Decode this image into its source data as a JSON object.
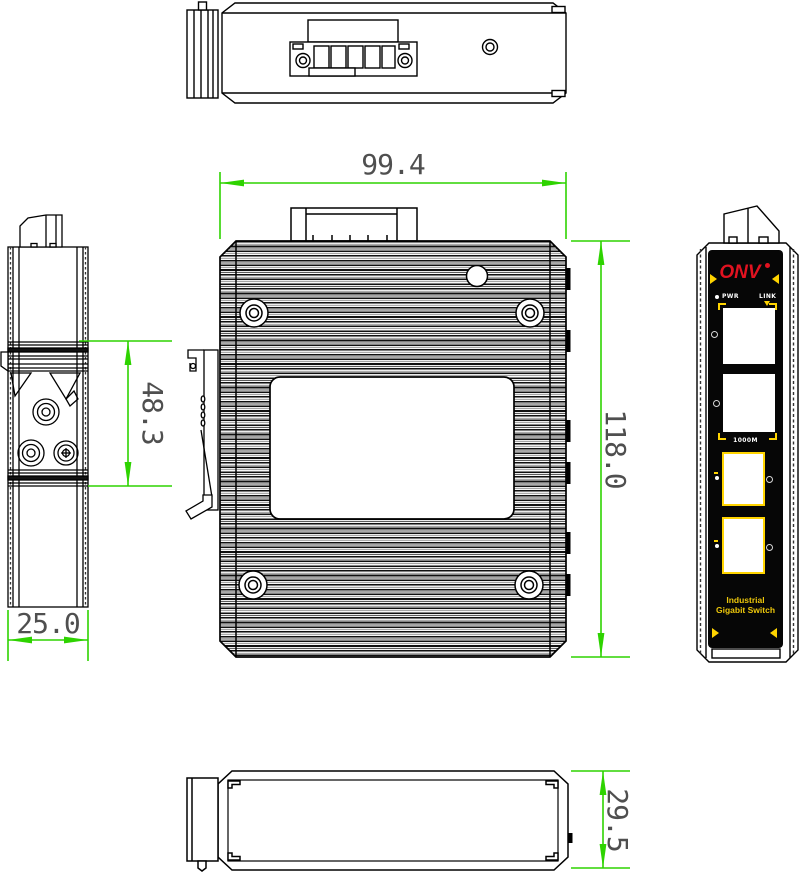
{
  "colors": {
    "dimension_line": "#2ed300",
    "dimension_text": "#4f4f4f",
    "panel_background": "#060606",
    "brand_red": "#e11220",
    "accent_yellow": "#ffd400",
    "drawing_line": "#000000"
  },
  "dimensions": {
    "body_width": "99.4",
    "body_height": "118.0",
    "side_width": "25.0",
    "din_section_height": "48.3",
    "body_depth": "29.5"
  },
  "front_panel": {
    "brand": "ONV",
    "led_pwr": "PWR",
    "led_link": "LINK",
    "speed_label": "1000M",
    "product_line1": "Industrial",
    "product_line2": "Gigabit Switch"
  }
}
